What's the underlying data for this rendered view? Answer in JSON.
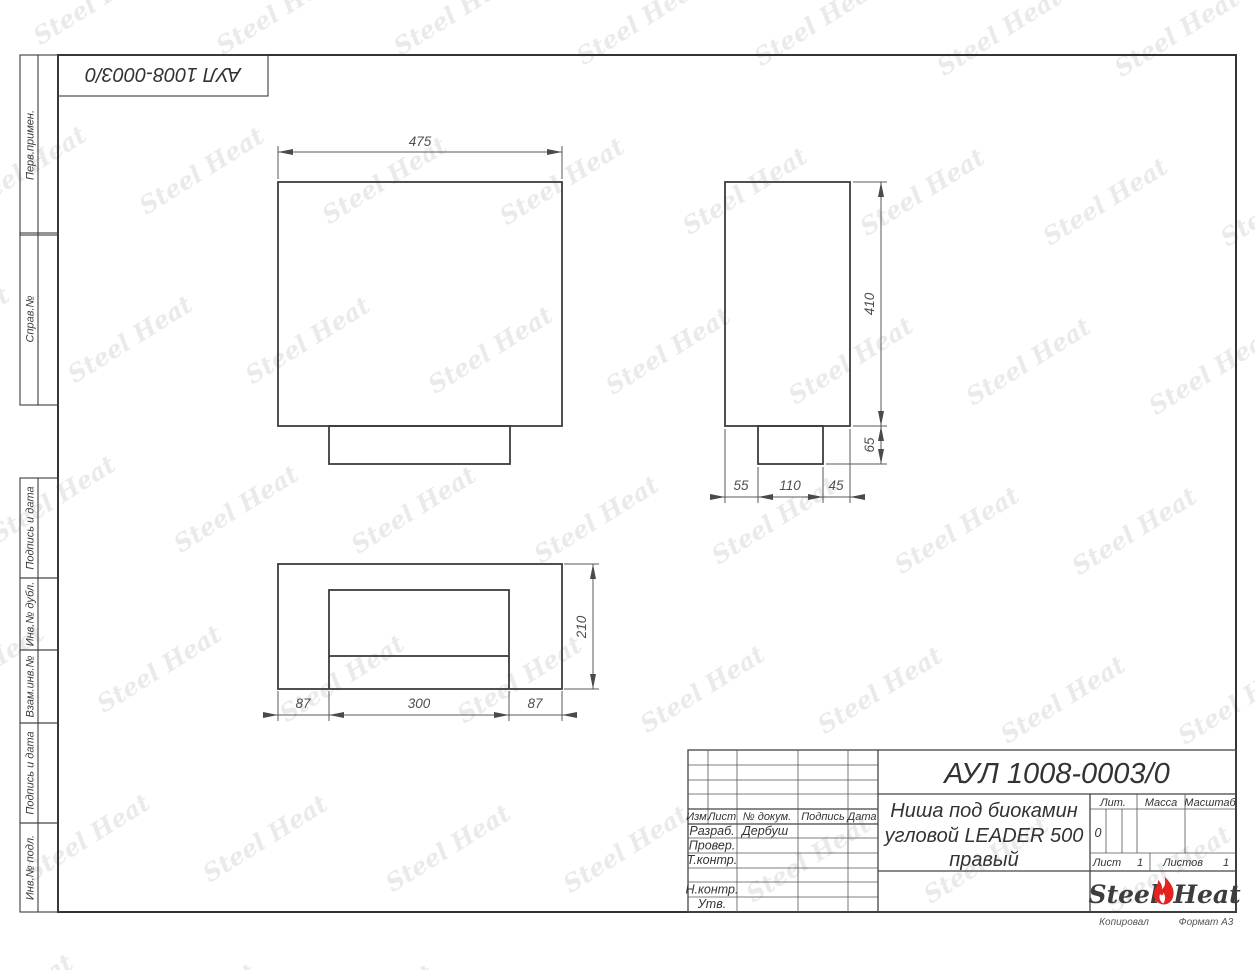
{
  "watermark": {
    "text": "Steel Heat"
  },
  "corner_stamp": {
    "text": "АУЛ 1008-0003/0"
  },
  "sidebar": {
    "labels": [
      "Перв.примен.",
      "Справ.№",
      "Подпись и дата",
      "Инв.№ дубл.",
      "Взам.инв.№",
      "Подпись и дата",
      "Инв.№ подл."
    ]
  },
  "drawing": {
    "front_view": {
      "width": "475"
    },
    "side_view": {
      "height": "410",
      "ledge_height": "65",
      "bottom_chain": [
        "55",
        "110",
        "45"
      ]
    },
    "plan_view": {
      "depth": "210",
      "bottom_chain": [
        "87",
        "300",
        "87"
      ]
    }
  },
  "title_block": {
    "designation": "АУЛ 1008-0003/0",
    "name_line1": "Ниша под биокамин",
    "name_line2": "угловой LEADER 500",
    "name_line3": "правый",
    "header": {
      "izm": "Изм.",
      "list": "Лист",
      "doc": "№ докум.",
      "sign": "Подпись",
      "date": "Дата"
    },
    "staff": [
      {
        "label": "Разраб.",
        "value": "Дербуш"
      },
      {
        "label": "Провер.",
        "value": ""
      },
      {
        "label": "Т.контр.",
        "value": ""
      },
      {
        "label": "Н.контр.",
        "value": ""
      },
      {
        "label": "Утв.",
        "value": ""
      }
    ],
    "lit": {
      "label": "Лит.",
      "value": "0"
    },
    "mass_label": "Масса",
    "scale_label": "Масштаб",
    "sheet": {
      "label": "Лист",
      "value": "1"
    },
    "sheets": {
      "label": "Листов",
      "value": "1"
    },
    "logo": {
      "left": "Steel",
      "right": "Heat"
    }
  },
  "footer": {
    "copied": "Копировал",
    "format": "Формат А3"
  }
}
